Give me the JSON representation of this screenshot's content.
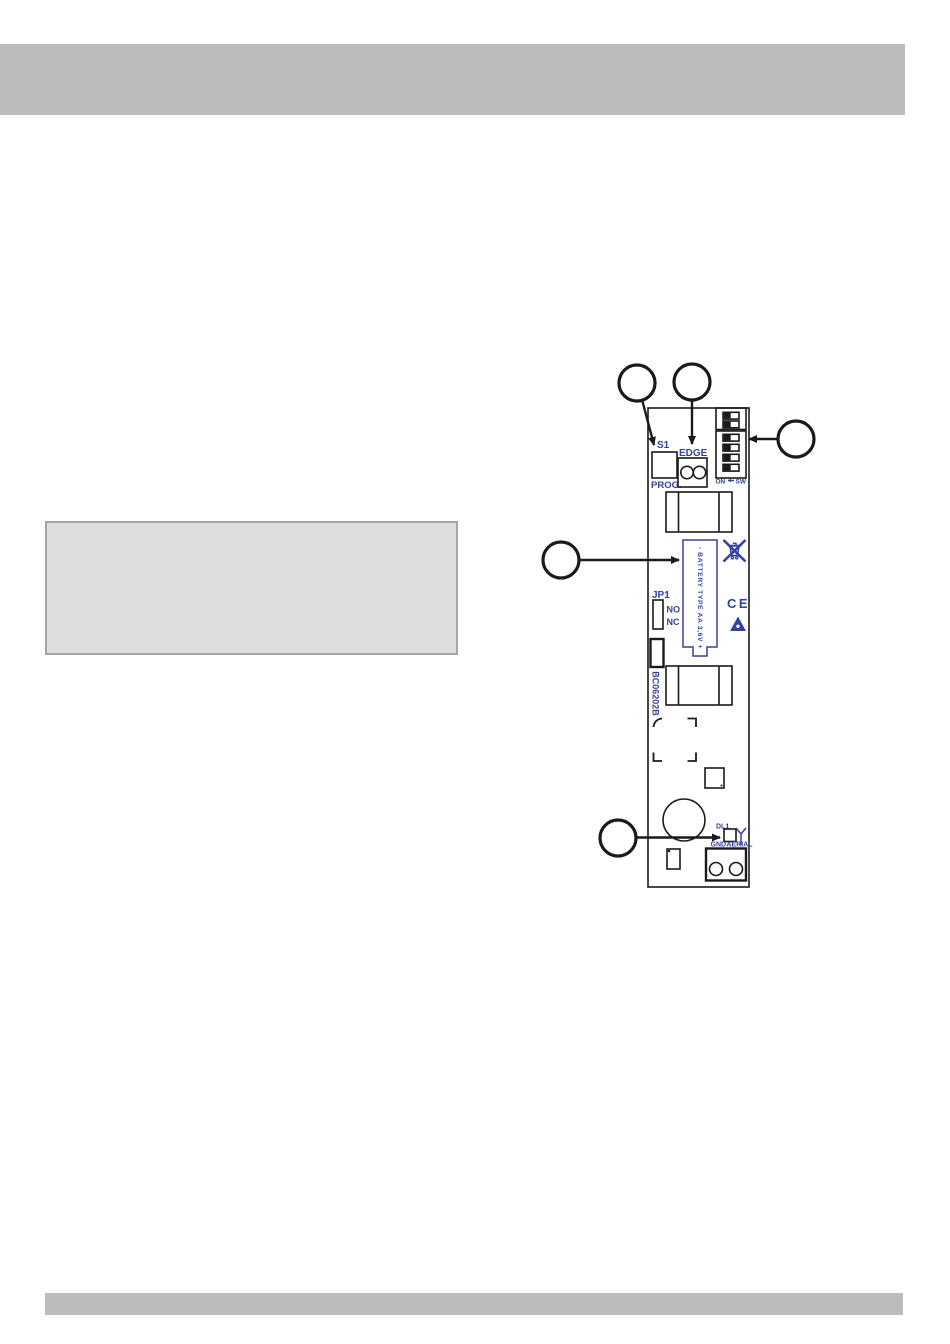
{
  "document": {
    "colors": {
      "page_background": "#ffffff",
      "bar_gray": "#bcbcbc",
      "note_box_fill": "#dedede",
      "note_box_border": "#a6a6a6",
      "diagram_blue": "#3640a0",
      "diagram_black": "#1a1a1a"
    }
  },
  "diagram": {
    "board": {
      "labels": {
        "s1": "S1",
        "prog": "PROG.",
        "edge": "EDGE",
        "dip_on": "ON",
        "dip_sw": "SW",
        "jp1": "JP1",
        "no": "NO",
        "nc": "NC",
        "board_code": "BC06202B",
        "battery": "- BATTERY TYPE AA 3,6V +",
        "ce_mark": "CE",
        "dl1": "DL1",
        "gnd": "GND",
        "aerial": "AERIAL"
      },
      "dip_switch": {
        "count": 6,
        "slider_side": "left",
        "groups": [
          2,
          4
        ]
      },
      "symbols": [
        "weee-crossed-bin",
        "ce-mark",
        "esd-warning-triangle",
        "aerial-antenna"
      ]
    },
    "callouts": [
      {
        "label": "",
        "points_to": "prog-button"
      },
      {
        "label": "",
        "points_to": "edge-terminal"
      },
      {
        "label": "",
        "points_to": "dip-switch"
      },
      {
        "label": "",
        "points_to": "battery"
      },
      {
        "label": "",
        "points_to": "dl1-led"
      }
    ]
  }
}
